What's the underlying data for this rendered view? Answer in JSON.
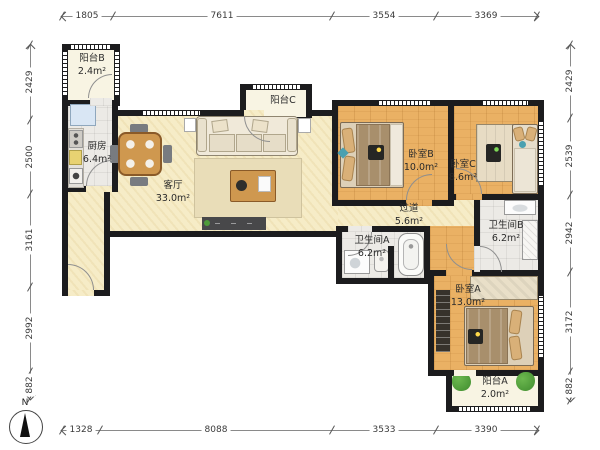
{
  "rooms": {
    "balcony_b": {
      "name": "阳台B",
      "area": "2.4m²"
    },
    "kitchen": {
      "name": "厨房",
      "area": "6.4m²"
    },
    "living_room": {
      "name": "客厅",
      "area": "33.0m²"
    },
    "balcony_c": {
      "name": "阳台C",
      "area": ""
    },
    "bedroom_b": {
      "name": "卧室B",
      "area": "10.0m²"
    },
    "bedroom_c": {
      "name": "卧室C",
      "area": "8.6m²"
    },
    "hallway": {
      "name": "过道",
      "area": "5.6m²"
    },
    "bathroom_a": {
      "name": "卫生间A",
      "area": "6.2m²"
    },
    "bathroom_b": {
      "name": "卫生间B",
      "area": "6.2m²"
    },
    "bedroom_a": {
      "name": "卧室A",
      "area": "13.0m²"
    },
    "balcony_a": {
      "name": "阳台A",
      "area": "2.0m²"
    }
  },
  "dimensions": {
    "top": [
      "1805",
      "7611",
      "3554",
      "3369"
    ],
    "bottom": [
      "1328",
      "8088",
      "3533",
      "3390"
    ],
    "left": [
      "2429",
      "2500",
      "3161",
      "2992",
      "882"
    ],
    "right": [
      "2429",
      "2539",
      "2942",
      "3172",
      "882"
    ]
  },
  "compass": {
    "label": "N"
  },
  "colors": {
    "wall": "#1c1c1e",
    "floor_wood": "#eab164",
    "floor_cream": "#f6ecc7",
    "floor_tile": "#eceae6",
    "floor_balcony": "#f8f4e3",
    "plant_green": "#4e9b3a",
    "fridge_blue": "#d9e6f4"
  }
}
